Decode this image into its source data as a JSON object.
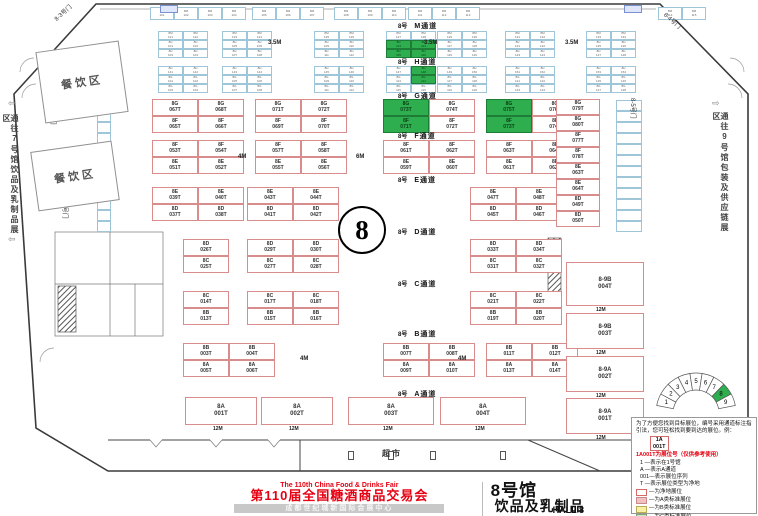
{
  "colors": {
    "accent_red": "#e60012",
    "booth_green": "#2eae4e",
    "booth_border": "#d98c8c",
    "small_border": "#9fc6d8"
  },
  "footer": {
    "fair_en": "The 110th China Food & Drinks Fair",
    "fair_cn": "第110届全国糖酒商品交易会",
    "venue": "成都世纪城新国际会展中心",
    "hall_cn": "8号馆",
    "category_cn": "饮品及乳制品",
    "hall_en": "HALL 8",
    "badge": "展位示意图",
    "category_en": "BEVERAGES AND DAIRY PRODUCTS"
  },
  "legend": {
    "intro": "为了方便您找到目标展位，编号采用通道标注指引法，您可轻松找到要到达的展位。例：",
    "example_top": "1A",
    "example_bottom": "001T",
    "note": "1A001T为展位号（仅供参考使用）",
    "items": [
      "1 —表示在1号馆",
      "A —表示A通道",
      "001—表示展位序列",
      "T —表示展位类型为净地"
    ],
    "rows": [
      {
        "color": "#ffffff",
        "border": "#d46a6a",
        "label": "—为净地展位"
      },
      {
        "color": "#f2c0c0",
        "border": "#c88a8a",
        "label": "—为A类标准展位"
      },
      {
        "color": "#f7f1a6",
        "border": "#bbab55",
        "label": "—为B类标准展位"
      },
      {
        "color": "#cfe9c9",
        "border": "#7aa87a",
        "label": "—为C类标准展位"
      },
      {
        "color": "#cdeaf4",
        "border": "#6fa6ba",
        "label": "—为D类标准展位"
      }
    ],
    "fire": "消防设施严禁遮挡"
  },
  "gauge": {
    "labels": [
      "1",
      "2",
      "3",
      "4",
      "5",
      "6",
      "7",
      "8",
      "9"
    ],
    "highlight": "8"
  },
  "map": {
    "hall_number": "8",
    "market": "超市",
    "dining": "餐饮区",
    "note_left": "通往7号馆饮品及乳制品展区",
    "note_right": "通往9号馆包装及供应链展区",
    "aisle_prefix": "8号",
    "aisles": [
      {
        "x": 398,
        "y": 21,
        "name": "M通道"
      },
      {
        "x": 398,
        "y": 57,
        "name": "H通道"
      },
      {
        "x": 398,
        "y": 91,
        "name": "G通道"
      },
      {
        "x": 398,
        "y": 131,
        "name": "F通道"
      },
      {
        "x": 398,
        "y": 175,
        "name": "E通道"
      },
      {
        "x": 398,
        "y": 227,
        "name": "D通道"
      },
      {
        "x": 398,
        "y": 279,
        "name": "C通道"
      },
      {
        "x": 398,
        "y": 329,
        "name": "B通道"
      },
      {
        "x": 398,
        "y": 389,
        "name": "A通道"
      }
    ],
    "gates": [
      {
        "x": 52,
        "y": 16,
        "r": -42,
        "t": "8-3号门"
      },
      {
        "x": 58,
        "y": 104,
        "r": 90,
        "t": "8-2号门"
      },
      {
        "x": 70,
        "y": 198,
        "r": 90,
        "t": "8-1号门"
      },
      {
        "x": 668,
        "y": 10,
        "r": 42,
        "t": "8-4号门"
      },
      {
        "x": 638,
        "y": 98,
        "r": 90,
        "t": "8-5号门"
      }
    ],
    "dining_boxes": [
      {
        "x": 40,
        "y": 46,
        "w": 84,
        "h": 72,
        "r": -8
      },
      {
        "x": 34,
        "y": 146,
        "w": 82,
        "h": 60,
        "r": -8
      }
    ],
    "bands": [
      {
        "y": 99,
        "h": 17,
        "w": 46,
        "blocks": [
          {
            "x": 152,
            "top": [
              "8G067T",
              "8G068T"
            ],
            "bottom": [
              "8F065T",
              "8F066T"
            ]
          },
          {
            "x": 255,
            "top": [
              "8G071T",
              "8G072T"
            ],
            "bottom": [
              "8F069T",
              "8F070T"
            ]
          },
          {
            "x": 383,
            "top": [
              "*8G073T",
              "8G074T"
            ],
            "bottom": [
              "*8F071T",
              "8F072T"
            ]
          },
          {
            "x": 486,
            "top": [
              "*8G075T",
              "8G076T"
            ],
            "bottom": [
              "*8F073T",
              "8F074T"
            ]
          }
        ]
      },
      {
        "y": 140,
        "h": 17,
        "w": 46,
        "blocks": [
          {
            "x": 152,
            "top": [
              "8F053T",
              "8F054T"
            ],
            "bottom": [
              "8E051T",
              "8E052T"
            ]
          },
          {
            "x": 255,
            "top": [
              "8F057T",
              "8F058T"
            ],
            "bottom": [
              "8E055T",
              "8E056T"
            ]
          },
          {
            "x": 383,
            "top": [
              "8F061T",
              "8F062T"
            ],
            "bottom": [
              "8E059T",
              "8E060T"
            ]
          },
          {
            "x": 486,
            "top": [
              "8F063T",
              "8F064T"
            ],
            "bottom": [
              "8E061T",
              "8E062T"
            ]
          }
        ]
      },
      {
        "y": 187,
        "h": 17,
        "w": 46,
        "blocks": [
          {
            "x": 152,
            "top": [
              "8E039T",
              "8E040T"
            ],
            "bottom": [
              "8D037T",
              "8D038T"
            ]
          },
          {
            "x": 247,
            "top": [
              "8E043T",
              "8E044T"
            ],
            "bottom": [
              "8D041T",
              "8D042T"
            ]
          },
          {
            "x": 470,
            "top": [
              "8E047T",
              "8E048T"
            ],
            "bottom": [
              "8D045T",
              "8D046T"
            ]
          }
        ]
      },
      {
        "y": 239,
        "h": 17,
        "w": 46,
        "blocks": [
          {
            "x": 183,
            "top": [
              "8D026T"
            ],
            "bottom": [
              "8C025T"
            ]
          },
          {
            "x": 247,
            "top": [
              "8D029T",
              "8D030T"
            ],
            "bottom": [
              "8C027T",
              "8C028T"
            ]
          },
          {
            "x": 470,
            "top": [
              "8D033T",
              "8D034T"
            ],
            "bottom": [
              "8C031T",
              "8C032T"
            ]
          }
        ]
      },
      {
        "y": 291,
        "h": 17,
        "w": 46,
        "blocks": [
          {
            "x": 183,
            "top": [
              "8C014T"
            ],
            "bottom": [
              "8B013T"
            ]
          },
          {
            "x": 247,
            "top": [
              "8C017T",
              "8C018T"
            ],
            "bottom": [
              "8B015T",
              "8B016T"
            ]
          },
          {
            "x": 470,
            "top": [
              "8C021T",
              "8C022T"
            ],
            "bottom": [
              "8B019T",
              "8B020T"
            ]
          }
        ]
      },
      {
        "y": 343,
        "h": 17,
        "w": 46,
        "blocks": [
          {
            "x": 183,
            "top": [
              "8B003T",
              "8B004T"
            ],
            "bottom": [
              "8A005T",
              "8A006T"
            ]
          },
          {
            "x": 383,
            "top": [
              "8B007T",
              "8B008T"
            ],
            "bottom": [
              "8A009T",
              "8A010T"
            ]
          },
          {
            "x": 486,
            "top": [
              "8B011T",
              "8B012T"
            ],
            "bottom": [
              "8A013T",
              "8A014T"
            ]
          }
        ]
      }
    ],
    "a_row": {
      "y": 397,
      "h": 28,
      "dim": "12M",
      "cells": [
        {
          "x": 185,
          "w": 72,
          "c": "8A001T"
        },
        {
          "x": 261,
          "w": 72,
          "c": "8A002T"
        },
        {
          "x": 348,
          "w": 86,
          "c": "8A003T"
        },
        {
          "x": 440,
          "w": 86,
          "c": "8A004T"
        }
      ]
    },
    "right_column": {
      "x": 556,
      "y": 99,
      "w": 44,
      "h": 16,
      "codes": [
        "8G079T",
        "8G080T",
        "8F077T",
        "8F078T",
        "8E063T",
        "8E064T",
        "8D049T",
        "8D050T"
      ]
    },
    "corridor": {
      "x": 566,
      "w": 78,
      "dim": "12M",
      "cells": [
        {
          "y": 262,
          "h": 44,
          "c": "8-9B004T"
        },
        {
          "y": 313,
          "h": 36,
          "c": "8-9B003T"
        },
        {
          "y": 356,
          "h": 36,
          "c": "8-9A002T"
        },
        {
          "y": 398,
          "h": 36,
          "c": "8-9A001T"
        }
      ]
    },
    "clusters": [
      {
        "x": 150,
        "y": 7,
        "cols": 4,
        "rows": 1,
        "cw": 24,
        "ch": 13,
        "p1": "8M",
        "s1": 101
      },
      {
        "x": 252,
        "y": 7,
        "cols": 3,
        "rows": 1,
        "cw": 24,
        "ch": 13,
        "p1": "8M",
        "s1": 105
      },
      {
        "x": 334,
        "y": 7,
        "cols": 3,
        "rows": 1,
        "cw": 24,
        "ch": 13,
        "p1": "8M",
        "s1": 108
      },
      {
        "x": 408,
        "y": 7,
        "cols": 3,
        "rows": 1,
        "cw": 24,
        "ch": 13,
        "p1": "8M",
        "s1": 111
      },
      {
        "x": 658,
        "y": 7,
        "cols": 2,
        "rows": 1,
        "cw": 24,
        "ch": 13,
        "p1": "8M",
        "s1": 114
      },
      {
        "x": 158,
        "y": 31,
        "cols": 2,
        "rows": 3,
        "cw": 25,
        "ch": 9,
        "p1": "8M",
        "s1": 121,
        "p2": "8H",
        "s2": 101
      },
      {
        "x": 222,
        "y": 31,
        "cols": 2,
        "rows": 3,
        "cw": 25,
        "ch": 9,
        "p1": "8M",
        "s1": 123,
        "p2": "8H",
        "s2": 105
      },
      {
        "x": 314,
        "y": 31,
        "cols": 2,
        "rows": 3,
        "cw": 25,
        "ch": 9,
        "p1": "8M",
        "s1": 125,
        "p2": "8H",
        "s2": 109
      },
      {
        "x": 386,
        "y": 31,
        "cols": 2,
        "rows": 3,
        "cw": 25,
        "ch": 9,
        "p1": "8M",
        "s1": 127,
        "p2": "8H",
        "s2": 113,
        "g": [
          "1,0",
          "1,1",
          "2,0",
          "2,1"
        ]
      },
      {
        "x": 437,
        "y": 31,
        "cols": 2,
        "rows": 3,
        "cw": 25,
        "ch": 9,
        "p1": "8M",
        "s1": 129,
        "p2": "8H",
        "s2": 117
      },
      {
        "x": 505,
        "y": 31,
        "cols": 2,
        "rows": 3,
        "cw": 25,
        "ch": 9,
        "p1": "8M",
        "s1": 131,
        "p2": "8H",
        "s2": 121
      },
      {
        "x": 586,
        "y": 31,
        "cols": 2,
        "rows": 3,
        "cw": 25,
        "ch": 9,
        "p1": "8M",
        "s1": 133,
        "p2": "8H",
        "s2": 125
      },
      {
        "x": 158,
        "y": 66,
        "cols": 2,
        "rows": 3,
        "cw": 25,
        "ch": 9,
        "p1": "8H",
        "s1": 141,
        "p2": "8G",
        "s2": 101
      },
      {
        "x": 222,
        "y": 66,
        "cols": 2,
        "rows": 3,
        "cw": 25,
        "ch": 9,
        "p1": "8H",
        "s1": 143,
        "p2": "8G",
        "s2": 105
      },
      {
        "x": 314,
        "y": 66,
        "cols": 2,
        "rows": 3,
        "cw": 25,
        "ch": 9,
        "p1": "8H",
        "s1": 145,
        "p2": "8G",
        "s2": 109
      },
      {
        "x": 386,
        "y": 66,
        "cols": 2,
        "rows": 3,
        "cw": 25,
        "ch": 9,
        "p1": "8H",
        "s1": 147,
        "p2": "8G",
        "s2": 113,
        "g": [
          "0,1",
          "1,1"
        ]
      },
      {
        "x": 437,
        "y": 66,
        "cols": 2,
        "rows": 3,
        "cw": 25,
        "ch": 9,
        "p1": "8H",
        "s1": 149,
        "p2": "8G",
        "s2": 117
      },
      {
        "x": 505,
        "y": 66,
        "cols": 2,
        "rows": 3,
        "cw": 25,
        "ch": 9,
        "p1": "8H",
        "s1": 151,
        "p2": "8G",
        "s2": 121
      },
      {
        "x": 586,
        "y": 66,
        "cols": 2,
        "rows": 3,
        "cw": 25,
        "ch": 9,
        "p1": "8H",
        "s1": 153,
        "p2": "8G",
        "s2": 125
      }
    ],
    "strips": [
      {
        "x": 97,
        "y": 100,
        "n": 12,
        "w": 14,
        "h": 11
      },
      {
        "x": 616,
        "y": 100,
        "n": 12,
        "w": 26,
        "h": 11
      }
    ],
    "dims": [
      {
        "x": 268,
        "y": 40,
        "t": "3.5M"
      },
      {
        "x": 424,
        "y": 40,
        "t": "3.5M"
      },
      {
        "x": 565,
        "y": 40,
        "t": "3.5M"
      },
      {
        "x": 238,
        "y": 154,
        "t": "4M"
      },
      {
        "x": 356,
        "y": 154,
        "t": "6M"
      },
      {
        "x": 300,
        "y": 356,
        "t": "4M"
      },
      {
        "x": 458,
        "y": 356,
        "t": "4M"
      }
    ],
    "arrows": [
      {
        "x": 8,
        "y": 98,
        "d": "⇦"
      },
      {
        "x": 8,
        "y": 234,
        "d": "⇦"
      },
      {
        "x": 712,
        "y": 98,
        "d": "⇨"
      }
    ],
    "utilities": [
      {
        "x": 160,
        "y": 5
      },
      {
        "x": 624,
        "y": 5
      }
    ],
    "hydrants": [
      {
        "x": 348,
        "y": 451
      },
      {
        "x": 388,
        "y": 451
      },
      {
        "x": 430,
        "y": 451
      },
      {
        "x": 500,
        "y": 451
      }
    ]
  }
}
